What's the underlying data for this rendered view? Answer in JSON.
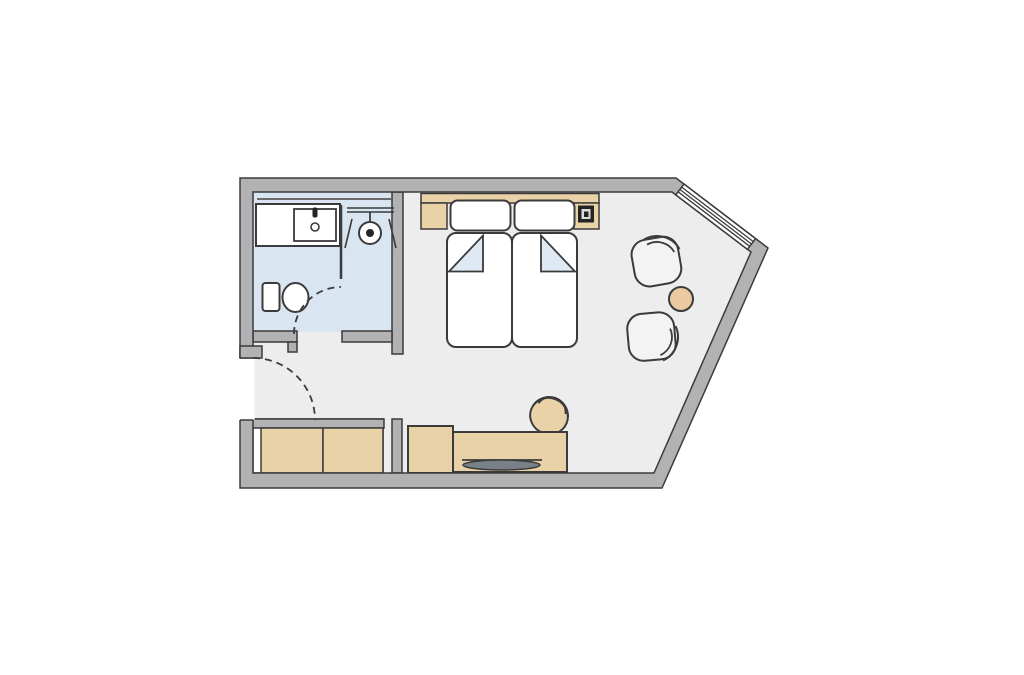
{
  "colors": {
    "wall": "#b2b2b5",
    "line": "#3b3b3b",
    "floor": "#ededee",
    "bath": "#d9e5f1",
    "tan": "#ead2a8",
    "table": "#ebc9a1",
    "fold": "#dfe9f4",
    "tv": "#7a8087",
    "chair": "#f3f3f3",
    "mirror": "#6b6b6b",
    "phone_dark": "#242424",
    "phone_light": "#dddddd"
  },
  "plan": {
    "kind": "hotel-room-floor-plan",
    "rooms": [
      {
        "name": "bathroom",
        "floor_color_key": "bath",
        "fixtures": [
          "vanity-counter",
          "sink",
          "faucet",
          "drain",
          "mirror-shelf",
          "glass-partition",
          "shower-rod",
          "shower-head",
          "toilet",
          "bathroom-door-swing"
        ]
      },
      {
        "name": "bedroom-living-area",
        "floor_color_key": "floor",
        "furniture": [
          "headboard",
          "nightstand-left",
          "nightstand-right",
          "phone-on-nightstand",
          "pillow-left",
          "pillow-right",
          "twin-bed-left",
          "twin-bed-right",
          "blanket-fold-left",
          "blanket-fold-right",
          "armchair-upper",
          "armchair-lower",
          "round-side-table",
          "wardrobe",
          "wardrobe-divider",
          "minibar-cabinet",
          "desk",
          "tv-on-desk",
          "desk-chair"
        ]
      }
    ],
    "openings": [
      "entry-door-swing",
      "window-on-angled-wall"
    ]
  }
}
